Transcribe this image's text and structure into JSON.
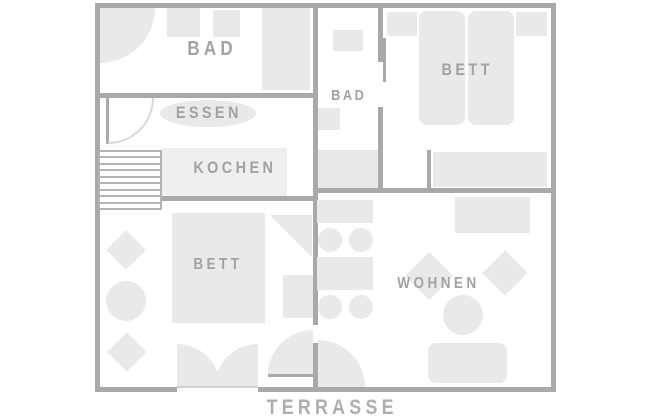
{
  "diagram_type": "apartment-floor-plan",
  "colors": {
    "wall": "#a9a9a9",
    "furniture": "#e9e9e9",
    "room_label": "#a2a2a2",
    "terrace_label": "#aeaeae",
    "background": "#ffffff"
  },
  "rooms": {
    "bath_upper_left": {
      "label": "BAD"
    },
    "dining": {
      "label": "ESSEN"
    },
    "kitchen": {
      "label": "KOCHEN"
    },
    "bath_upper_mid": {
      "label": "BAD"
    },
    "bedroom_upper_right": {
      "label": "BETT"
    },
    "bedroom_lower_left": {
      "label": "BETT"
    },
    "living": {
      "label": "WOHNEN"
    },
    "terrace": {
      "label": "TERRASSE"
    }
  }
}
